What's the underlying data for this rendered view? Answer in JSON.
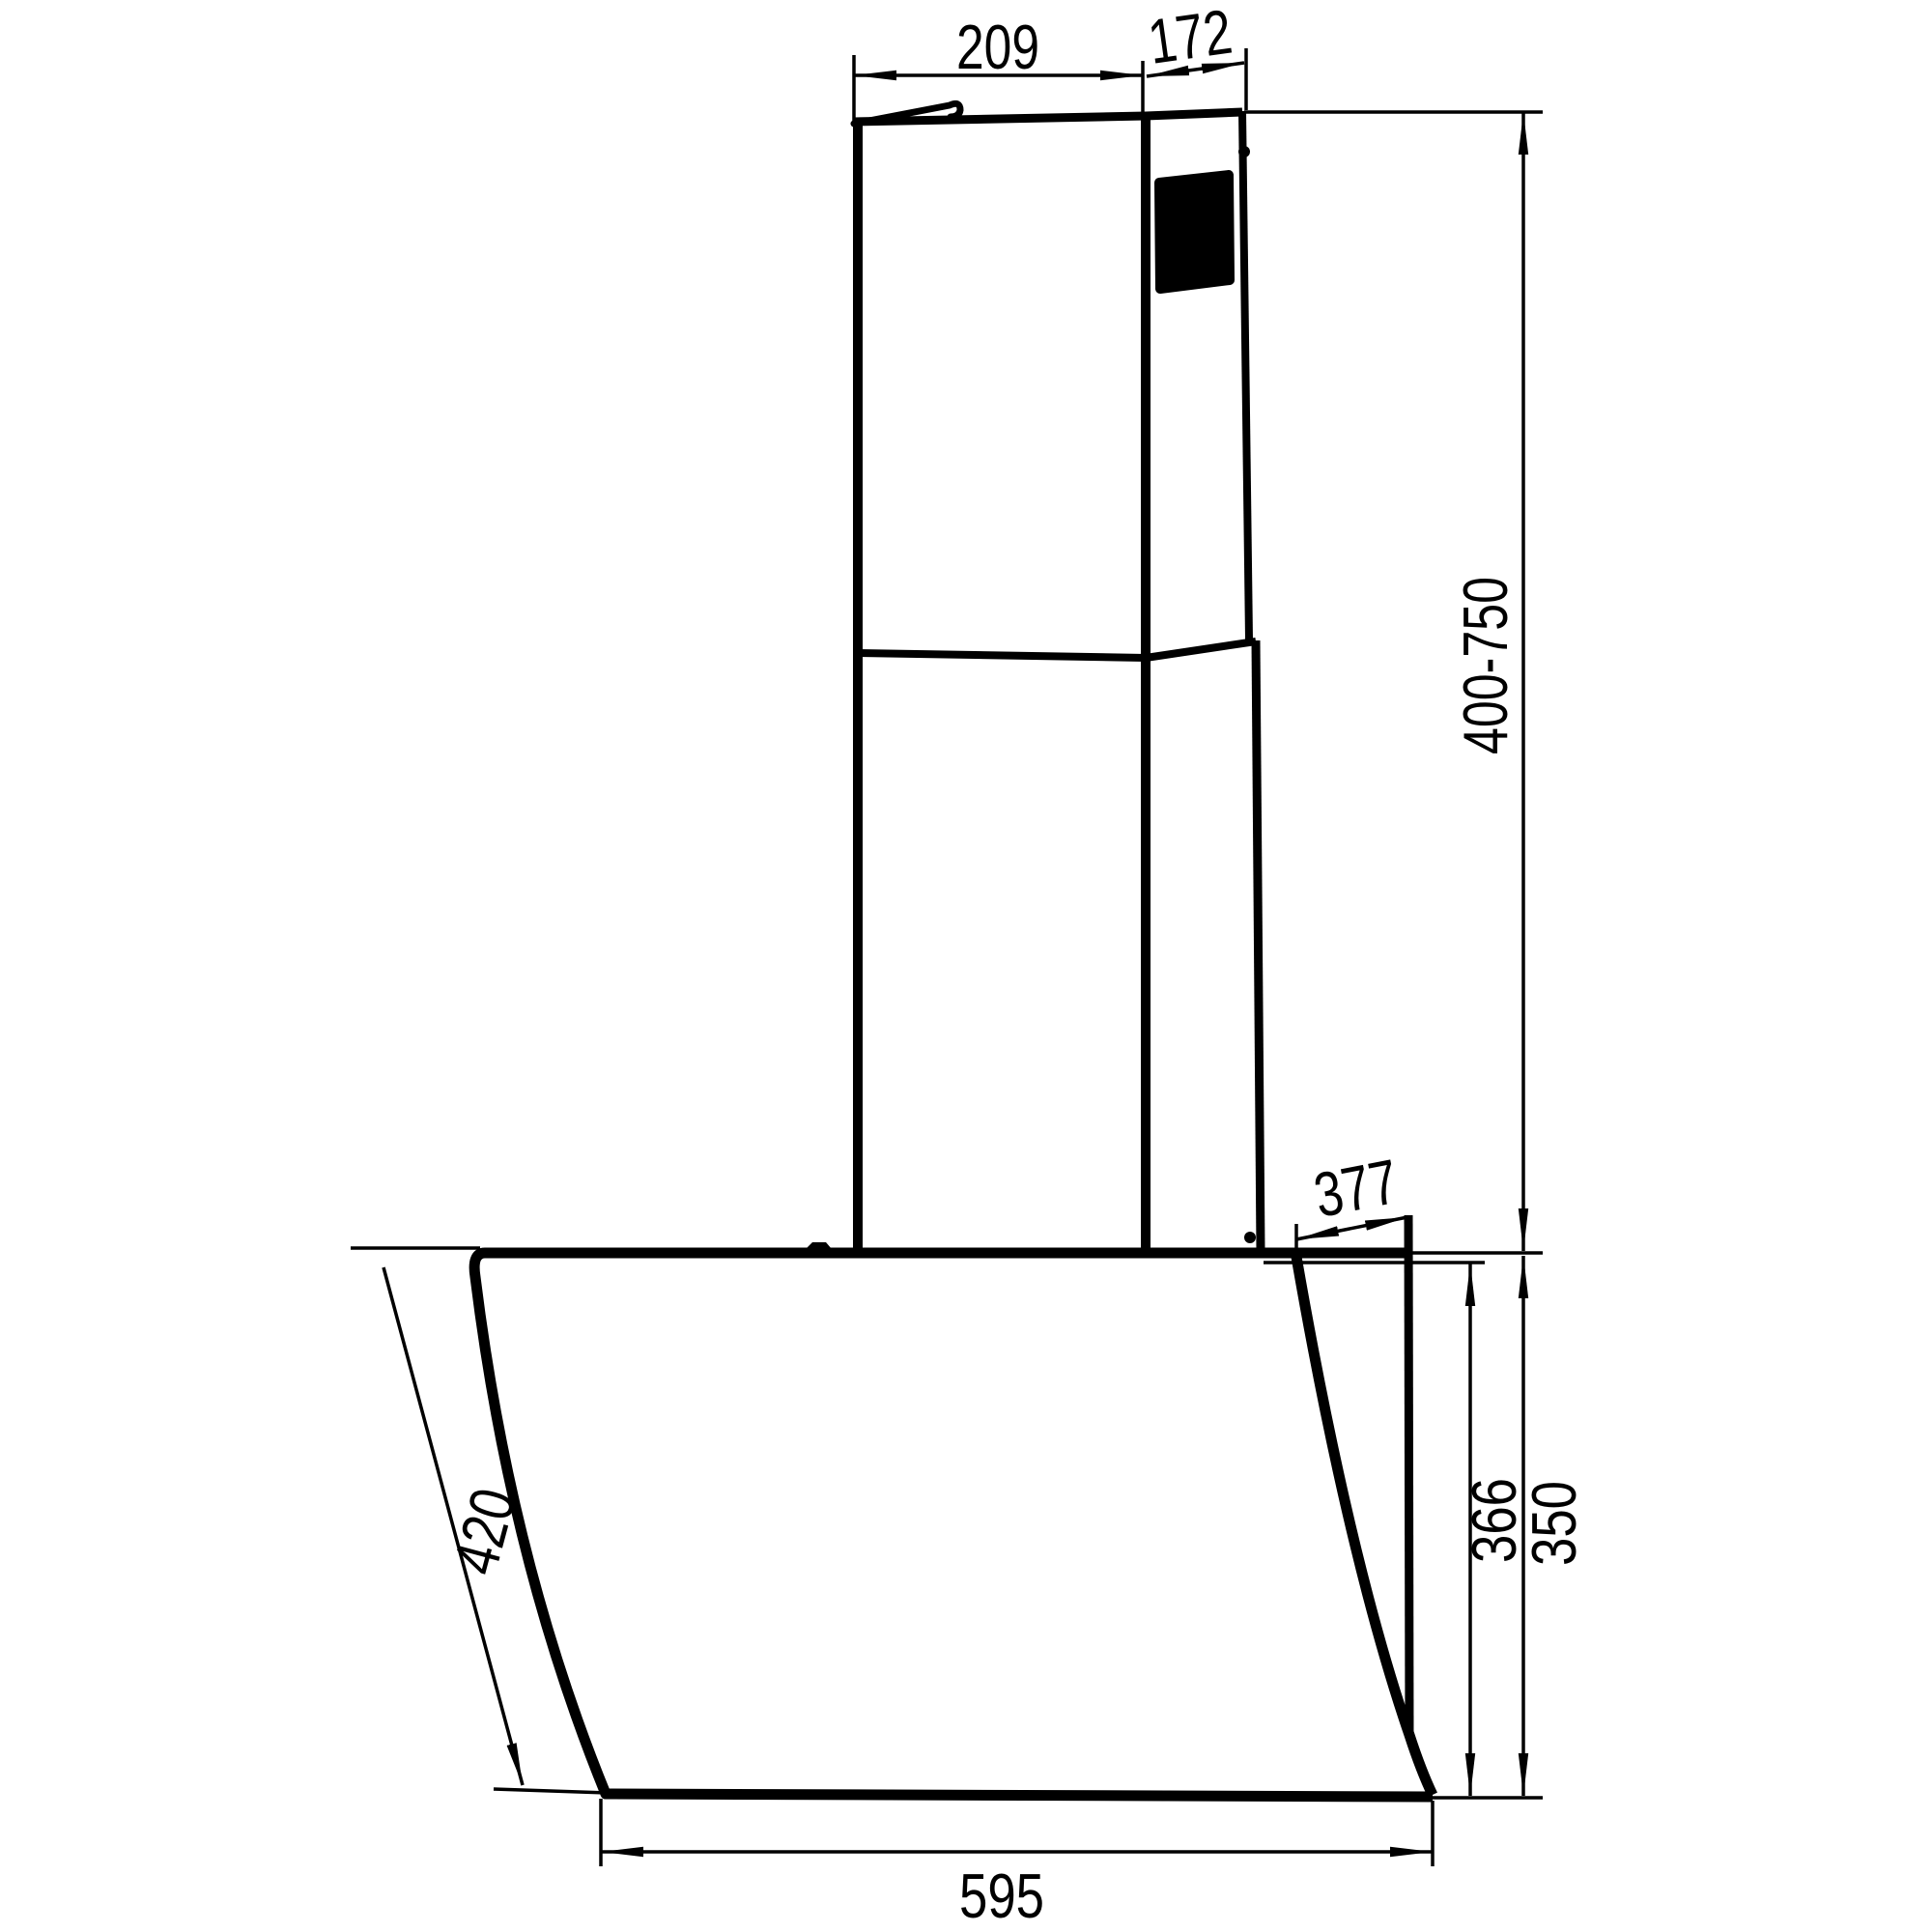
{
  "drawing": {
    "background_color": "#ffffff",
    "line_color": "#000000",
    "subject": "cooker-hood-dimension-drawing",
    "dim": {
      "chimney_width": "209",
      "chimney_depth": "172",
      "chimney_height_range": "400-750",
      "body_top_depth": "377",
      "glass_slant_length": "420",
      "body_rear_height": "366",
      "body_height": "350",
      "body_width": "595"
    }
  }
}
